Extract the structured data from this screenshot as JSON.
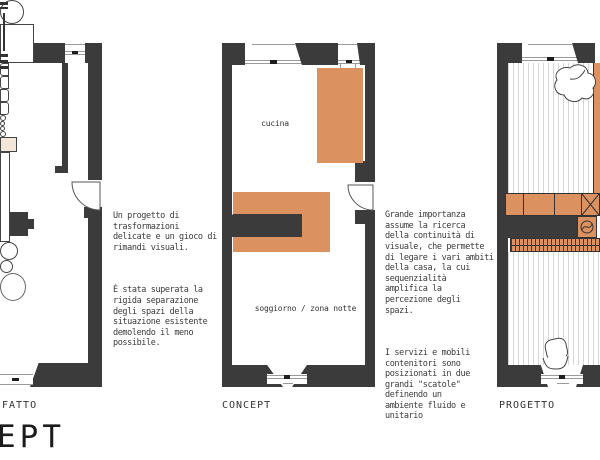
{
  "colors": {
    "accent_orange": "#dc9260",
    "wall_gray": "#3b3b3b"
  },
  "panels": {
    "fatto": {
      "label": "FATTO"
    },
    "concept": {
      "label": "CONCEPT",
      "room_labels": {
        "kitchen": "cucina",
        "living": "soggiorno / zona notte"
      }
    },
    "progetto": {
      "label": "PROGETTO"
    }
  },
  "annotations": {
    "left": {
      "para1": "Un progetto di\ntrasformazioni\ndelicate e un gioco di\nrimandi visuali.",
      "para2": "È stata superata la\nrigida separazione\ndegli spazi della\nsituazione esistente\ndemolendo il meno\npossibile."
    },
    "right": {
      "para1": "Grande importanza\nassume la ricerca\ndella continuità di\nvisuale, che permette\ndi legare i vari ambiti\ndella casa, la cui\nsequenzialità\namplifica la\npercezione degli\nspazi.",
      "para2": "I servizi e mobili\ncontenitori sono\nposizionati in due\ngrandi \"scatole\"\ndefinendo un\nambiente fluido e\nunitario"
    }
  },
  "watermark": "EPT"
}
